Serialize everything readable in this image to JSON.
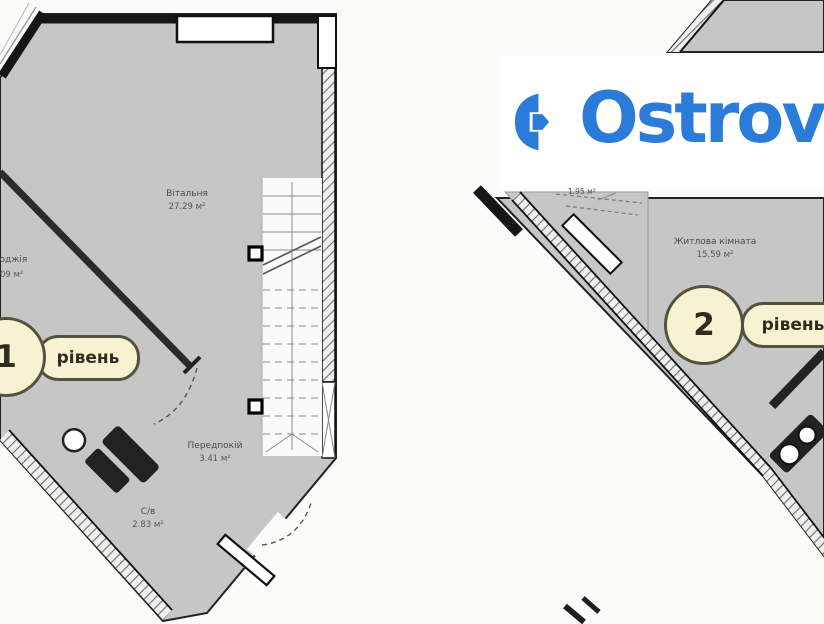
{
  "logo": {
    "text": "Ostrov",
    "color": "#2b7cd9"
  },
  "level1": {
    "badge": {
      "number": "1",
      "label": "рівень"
    },
    "rooms": {
      "living": {
        "name": "Вітальня",
        "area": "27.29 м²"
      },
      "loggia": {
        "name": "Лоджія",
        "area": "09 м²"
      },
      "hallway": {
        "name": "Передпокій",
        "area": "3.41 м²"
      },
      "bathroom": {
        "name": "С/в",
        "area": "2.83 м²"
      }
    }
  },
  "level2": {
    "badge": {
      "number": "2",
      "label": "рівень"
    },
    "rooms": {
      "bedroom": {
        "name": "Житлова кімната",
        "area": "15.59 м²"
      },
      "balcony": {
        "area": "1.95 м²"
      }
    }
  },
  "colors": {
    "plan_fill": "#c6c6c6",
    "wall": "#1c1c1c",
    "badge_fill": "#f7f3d2",
    "badge_border": "#53523f",
    "logo_blue": "#2b7cd9"
  }
}
